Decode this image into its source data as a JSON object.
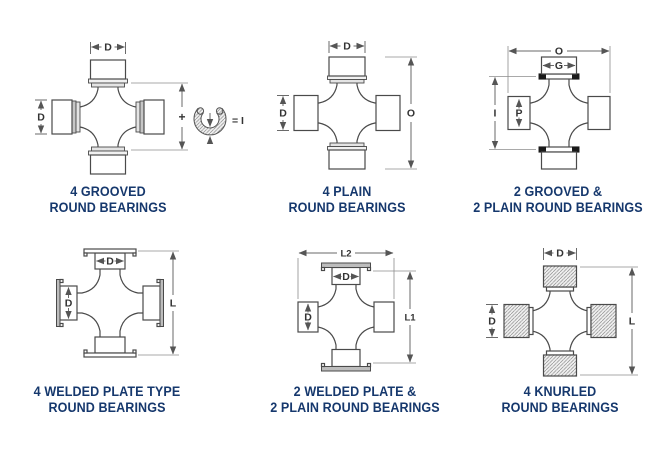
{
  "figure": {
    "title": "universal joint bearing style diagrams"
  },
  "colors": {
    "caption_text": "#16386d",
    "part_line": "#4a4a4a",
    "dim_line": "#6a6a6a",
    "groove": "#1a1a1a"
  },
  "diagrams": [
    {
      "caption": [
        "4 GROOVED",
        "ROUND BEARINGS"
      ],
      "dims": {
        "top_width": "D",
        "left_diameter": "D",
        "inner_span_plus": "+",
        "snap_ring_equation": "= I"
      }
    },
    {
      "caption": [
        "4 PLAIN",
        "ROUND BEARINGS"
      ],
      "dims": {
        "top_width": "D",
        "left_diameter": "D",
        "overall_length": "O"
      }
    },
    {
      "caption": [
        "2 GROOVED &",
        "2 PLAIN ROUND BEARINGS"
      ],
      "dims": {
        "overall_length": "O",
        "cap_width": "G",
        "inner_span": "I",
        "cap_diameter": "P"
      }
    },
    {
      "caption": [
        "4 WELDED PLATE TYPE",
        "ROUND BEARINGS"
      ],
      "dims": {
        "cap_width": "D",
        "cap_diameter": "D",
        "overall_length": "L"
      }
    },
    {
      "caption": [
        "2 WELDED PLATE &",
        "2 PLAIN ROUND BEARINGS"
      ],
      "dims": {
        "overall_width": "L2",
        "cap_width": "D",
        "cap_diameter": "D",
        "overall_length": "L1"
      }
    },
    {
      "caption": [
        "4 KNURLED",
        "ROUND BEARINGS"
      ],
      "dims": {
        "top_width": "D",
        "left_diameter": "D",
        "overall_length": "L"
      }
    }
  ]
}
